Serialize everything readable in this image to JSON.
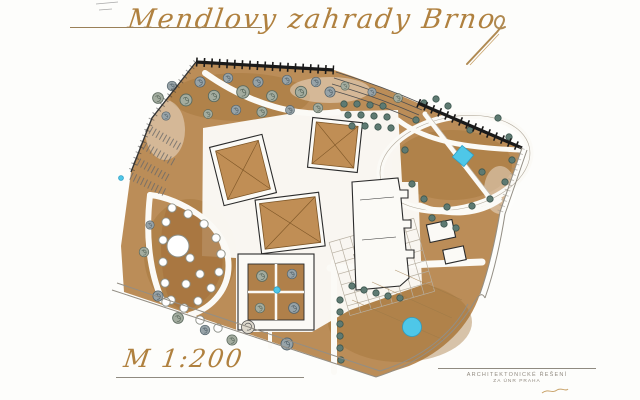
{
  "title": {
    "text": "Mendlovy zahrady Brno"
  },
  "scale_label": {
    "text": "M 1:200"
  },
  "title_block": {
    "line1": "ARCHITEKTONICKÉ ŘEŠENÍ",
    "line2": "ZA ÚNR PRAHA"
  },
  "colors": {
    "paper_white": "#fdfdfb",
    "ink_gold": "#b0813f",
    "ground_brown": "#b5834a",
    "roof_tan": "#c08e55",
    "water_cyan": "#4ec7e8",
    "tree_sage": "#a3ac9f",
    "tree_slate": "#97a3a8",
    "tree_dark_teal": "#5e7a72",
    "boundary_black": "#1a1a1a"
  }
}
